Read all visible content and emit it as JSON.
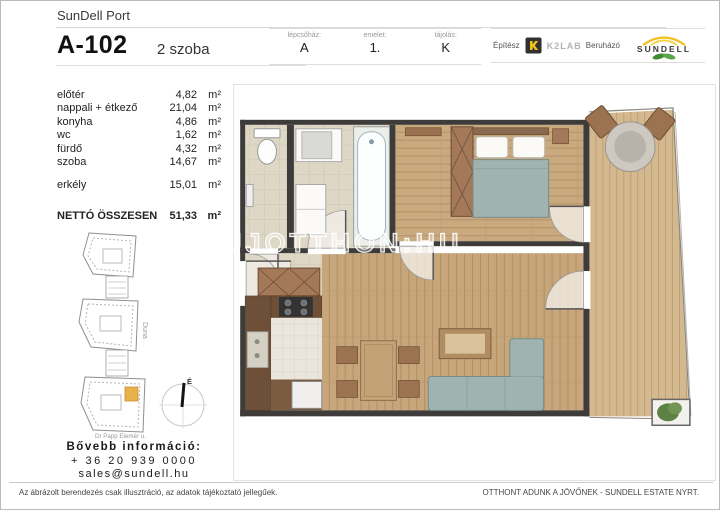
{
  "header": {
    "project": "SunDell Port",
    "unit_id": "A-102",
    "unit_type": "2 szoba",
    "staircase_label": "lépcsőház:",
    "staircase_value": "A",
    "floor_label": "emelet:",
    "floor_value": "1.",
    "orientation_label": "tájolás:",
    "orientation_value": "K",
    "architect_label": "Építész",
    "architect_name": "K2LAB",
    "developer_label": "Beruházó",
    "developer_name": "SUNDELL"
  },
  "rooms": {
    "unit": "m²",
    "items": [
      {
        "name": "előtér",
        "area": "4,82"
      },
      {
        "name": "nappali + étkező",
        "area": "21,04"
      },
      {
        "name": "konyha",
        "area": "4,86"
      },
      {
        "name": "wc",
        "area": "1,62"
      },
      {
        "name": "fürdő",
        "area": "4,32"
      },
      {
        "name": "szoba",
        "area": "14,67"
      }
    ],
    "balcony_name": "erkély",
    "balcony_area": "15,01",
    "total_name": "NETTÓ ÖSSZESEN",
    "total_area": "51,33"
  },
  "siteplan": {
    "river_label": "Duna",
    "street_label": "Dr Papp Elemér u.",
    "compass_label": "É"
  },
  "contact": {
    "heading": "Bővebb információ:",
    "phone": "+ 36 20 939 0000",
    "email": "sales@sundell.hu"
  },
  "floorplan": {
    "watermark": "UJOTTHON:HU"
  },
  "footer": {
    "disclaimer": "Az ábrázolt berendezés csak illusztráció, az adatok tájékoztató jellegűek.",
    "slogan": "OTTHONT ADUNK A JÖVŐNEK - SUNDELL ESTATE NYRT."
  },
  "colors": {
    "accent_yellow": "#f2c01d",
    "leaf_green": "#4a9b3c",
    "wall": "#3d3c3a",
    "wood_floor": "#c9a97e",
    "deck": "#d4b88f",
    "tile": "#ded7c5",
    "upholstery": "#a0b3b0",
    "unit_highlight": "#e8b24a"
  }
}
